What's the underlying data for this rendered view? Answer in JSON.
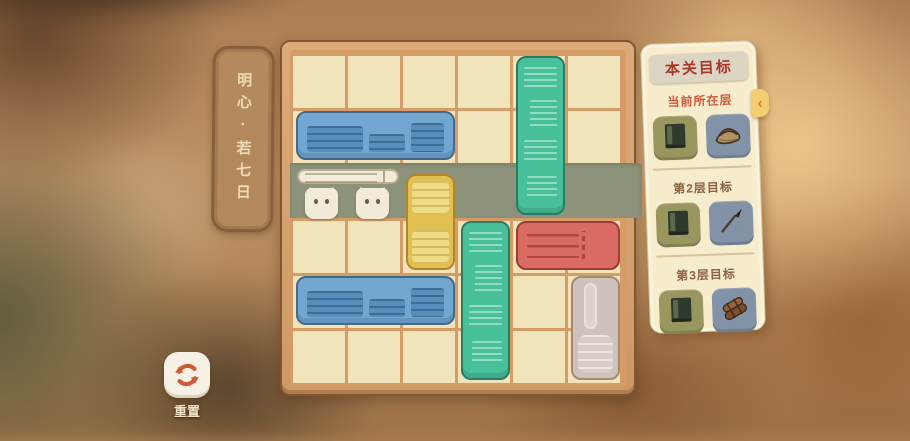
{
  "level_label": {
    "text": "明心·若七日"
  },
  "board": {
    "cols": 6,
    "rows": 6,
    "exit_row": 2,
    "exit_side": "right",
    "blocks": [
      {
        "id": "blue-bookshelf-top",
        "style": "blue-books",
        "col": 0,
        "row": 1,
        "w": 3,
        "h": 1
      },
      {
        "id": "green-bookstack-top",
        "style": "green-books",
        "col": 4,
        "row": 0,
        "w": 1,
        "h": 3
      },
      {
        "id": "cats-carrying-scroll",
        "style": "cats",
        "col": 0,
        "row": 2,
        "w": 2,
        "h": 1
      },
      {
        "id": "yellow-crate",
        "style": "yellow",
        "col": 2,
        "row": 2,
        "w": 1,
        "h": 2,
        "pad_top": 8
      },
      {
        "id": "green-bookstack-bottom",
        "style": "green-books",
        "col": 3,
        "row": 3,
        "w": 1,
        "h": 3
      },
      {
        "id": "red-book",
        "style": "red",
        "col": 4,
        "row": 3,
        "w": 2,
        "h": 1
      },
      {
        "id": "blue-bookshelf-bottom",
        "style": "blue-books",
        "col": 0,
        "row": 4,
        "w": 3,
        "h": 1
      },
      {
        "id": "white-chest",
        "style": "white",
        "col": 5,
        "row": 4,
        "w": 1,
        "h": 2
      }
    ]
  },
  "goals_panel": {
    "title": "本关目标",
    "sections": [
      {
        "label": "当前所在层",
        "label_color": "#d4563a",
        "tiles": [
          {
            "icon": "book-icon",
            "bg": "#9a9660"
          },
          {
            "icon": "straw-hat-icon",
            "bg": "#8293a8"
          }
        ]
      },
      {
        "label": "第2层目标",
        "label_color": "#8d6142",
        "tiles": [
          {
            "icon": "book-icon",
            "bg": "#9a9660"
          },
          {
            "icon": "brush-icon",
            "bg": "#8293a8"
          }
        ]
      },
      {
        "label": "第3层目标",
        "label_color": "#8d6142",
        "tiles": [
          {
            "icon": "book-icon",
            "bg": "#9a9660"
          },
          {
            "icon": "scroll-icon",
            "bg": "#8293a8"
          }
        ]
      }
    ]
  },
  "reset": {
    "label": "重置"
  },
  "colors": {
    "lane": "#8c937a",
    "cell": "#f2e4ba",
    "grid_line": "#d59c68",
    "board_wood": "#d5a270",
    "panel_bg": "#f7edcd",
    "block_blue": "#72a7d1",
    "block_green": "#49c09c",
    "block_yellow": "#e1bf52",
    "block_red": "#d96b62",
    "block_white": "#cfc2ba",
    "piece_cream": "#f2ebd8"
  }
}
